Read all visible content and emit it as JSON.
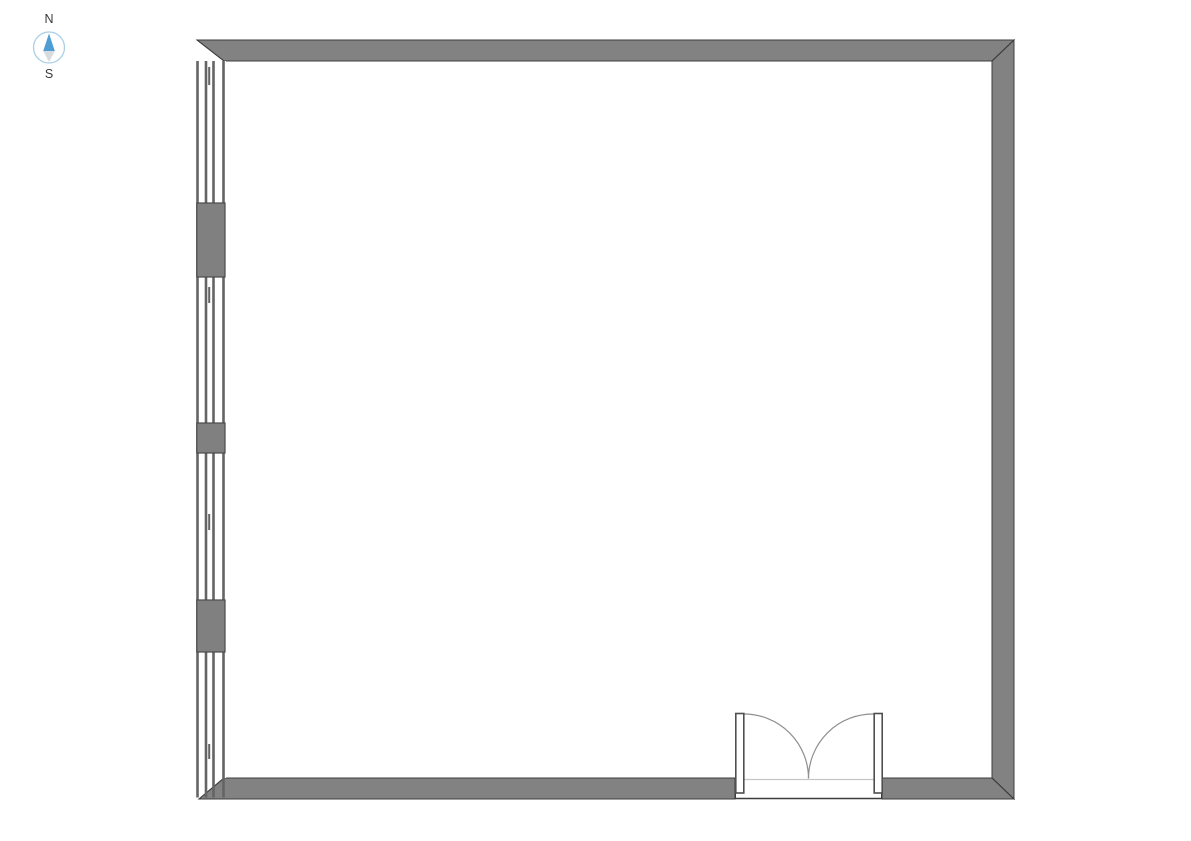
{
  "compass": {
    "north_label": "N",
    "south_label": "S"
  },
  "floor_plan": {
    "shape": "square-room",
    "door": {
      "type": "double-swing",
      "wall": "south"
    },
    "window_wall": "west",
    "window_segments": 4,
    "wall_piers": 3
  },
  "colors": {
    "background": "#ffffff",
    "wall_fill": "#828282",
    "wall_outline": "#3d3d3d",
    "window_line": "#646464",
    "pier_fill": "#808080",
    "pier_stroke": "#4a4a4a",
    "door_arc": "#8f8f8f",
    "door_leaf_outline": "#4f4f4f",
    "threshold_light": "#c6c6c6",
    "threshold_dark": "#3d3d3d",
    "compass_ring": "#a9cfe6",
    "compass_north": "#4e9ed3",
    "compass_south": "#d7dbdf",
    "label_text": "#3a3a3a"
  }
}
